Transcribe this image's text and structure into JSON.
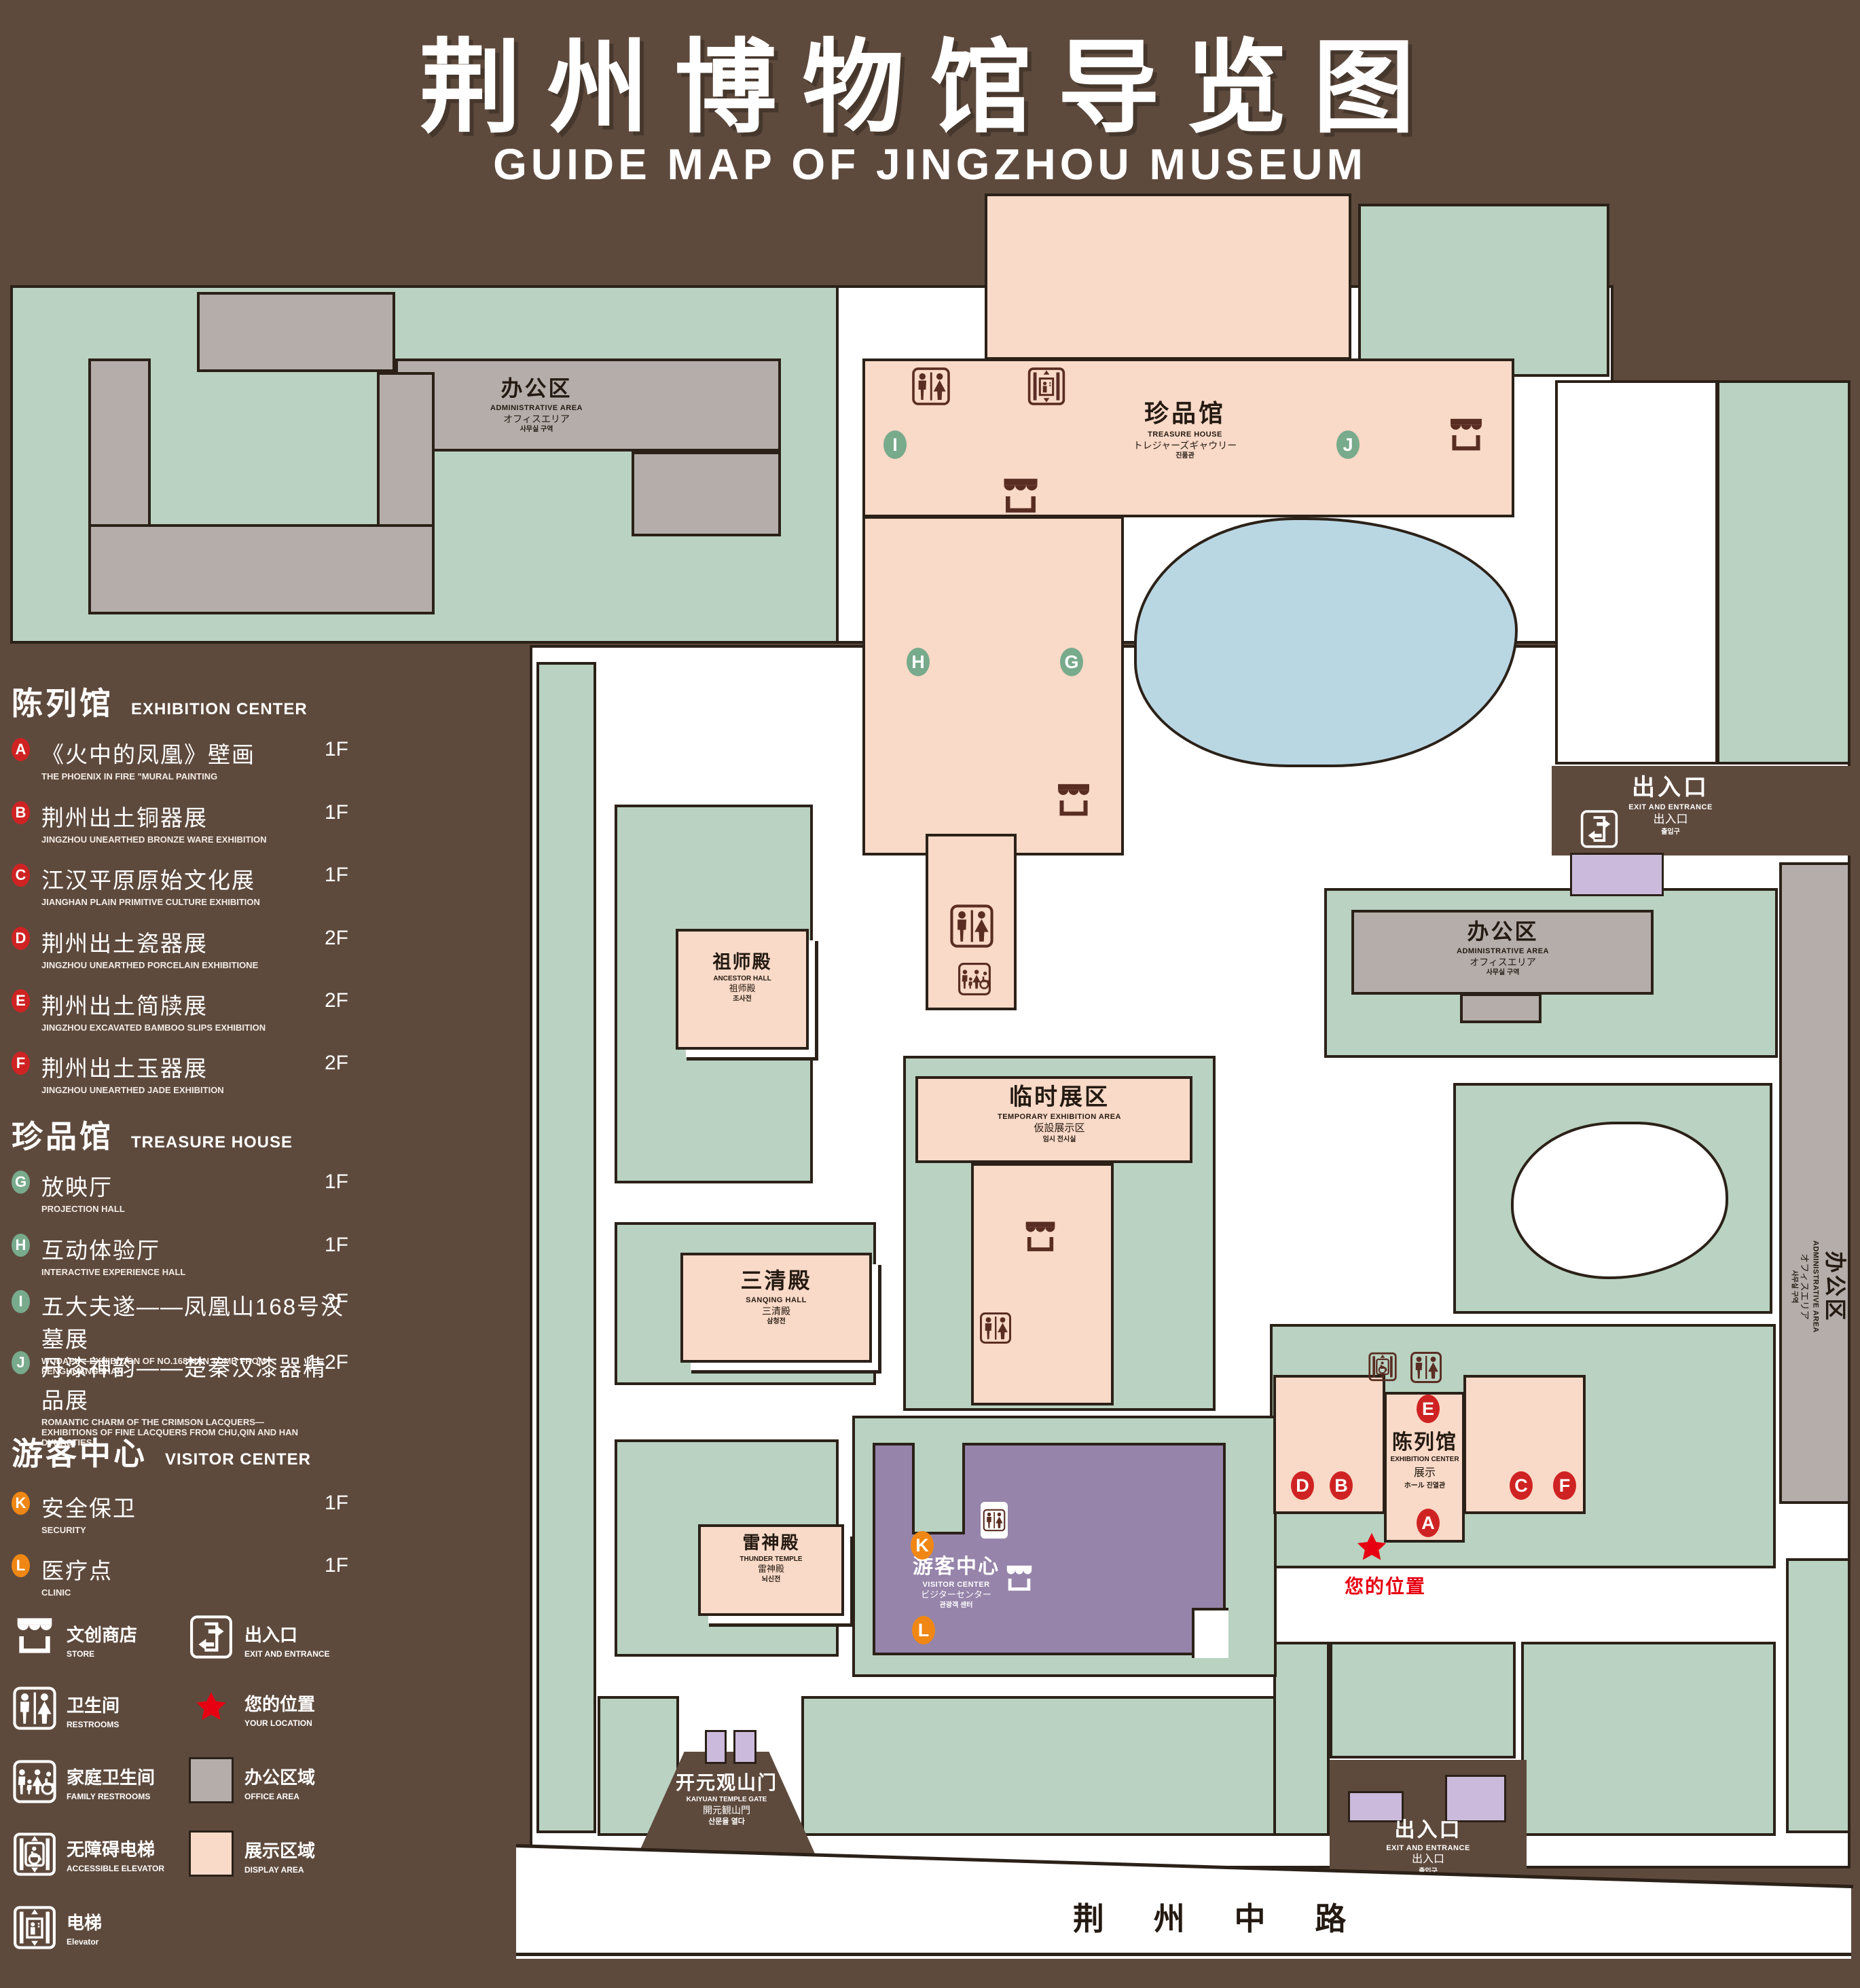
{
  "title": {
    "cn": "荆州博物馆导览图",
    "en": "GUIDE MAP OF JINGZHOU MUSEUM"
  },
  "legend": {
    "sections": [
      {
        "title_cn": "陈列馆",
        "title_en": "EXHIBITION CENTER",
        "items": [
          {
            "letter": "A",
            "cn": "《火中的凤凰》壁画",
            "en": "THE PHOENIX IN FIRE \"MURAL PAINTING",
            "floor": "1F"
          },
          {
            "letter": "B",
            "cn": "荆州出土铜器展",
            "en": "JINGZHOU UNEARTHED BRONZE WARE EXHIBITION",
            "floor": "1F"
          },
          {
            "letter": "C",
            "cn": "江汉平原原始文化展",
            "en": "JIANGHAN PLAIN PRIMITIVE CULTURE EXHIBITION",
            "floor": "1F"
          },
          {
            "letter": "D",
            "cn": "荆州出土瓷器展",
            "en": "JINGZHOU UNEARTHED PORCELAIN EXHIBITIONE",
            "floor": "2F"
          },
          {
            "letter": "E",
            "cn": "荆州出土简牍展",
            "en": "JINGZHOU EXCAVATED BAMBOO SLIPS EXHIBITION",
            "floor": "2F"
          },
          {
            "letter": "F",
            "cn": "荆州出土玉器展",
            "en": "JINGZHOU UNEARTHED JADE EXHIBITION",
            "floor": "2F"
          }
        ]
      },
      {
        "title_cn": "珍品馆",
        "title_en": "TREASURE HOUSE",
        "items": [
          {
            "letter": "G",
            "cn": "放映厅",
            "en": "PROJECTION HALL",
            "floor": "1F"
          },
          {
            "letter": "H",
            "cn": "互动体验厅",
            "en": "INTERACTIVE EXPERIENCE HALL",
            "floor": "1F"
          },
          {
            "letter": "I",
            "cn": "五大夫遂——凤凰山168号汉墓展",
            "en": "WUDAFU—EXHIBITION OF NO.168 HAN TOMB FROM FENGHUANGSHAN",
            "floor": "2F"
          },
          {
            "letter": "J",
            "cn": "丹漆神韵——楚秦汉漆器精品展",
            "en": "ROMANTIC CHARM OF THE CRIMSON LACQUERS—EXHIBITIONS OF FINE LACQUERS FROM CHU,QIN AND HAN DYNASTIES",
            "floor": "1-2F"
          }
        ]
      },
      {
        "title_cn": "游客中心",
        "title_en": "VISITOR CENTER",
        "items": [
          {
            "letter": "K",
            "cn": "安全保卫",
            "en": "SECURITY",
            "floor": "1F"
          },
          {
            "letter": "L",
            "cn": "医疗点",
            "en": "CLINIC",
            "floor": "1F"
          }
        ]
      }
    ],
    "symbols": [
      {
        "icon": "store-icon",
        "cn": "文创商店",
        "en": "STORE"
      },
      {
        "icon": "exit-icon",
        "cn": "出入口",
        "en": "EXIT AND ENTRANCE"
      },
      {
        "icon": "restroom-icon",
        "cn": "卫生间",
        "en": "RESTROOMS"
      },
      {
        "icon": "location-star-icon",
        "cn": "您的位置",
        "en": "YOUR LOCATION"
      },
      {
        "icon": "family-restroom-icon",
        "cn": "家庭卫生间",
        "en": "FAMILY RESTROOMS"
      },
      {
        "icon": "office-area-swatch",
        "cn": "办公区域",
        "en": "OFFICE AREA"
      },
      {
        "icon": "accessible-elevator-icon",
        "cn": "无障碍电梯",
        "en": "ACCESSIBLE ELEVATOR"
      },
      {
        "icon": "display-area-swatch",
        "cn": "展示区域",
        "en": "DISPLAY AREA"
      },
      {
        "icon": "elevator-icon",
        "cn": "电梯",
        "en": "Elevator"
      }
    ]
  },
  "map": {
    "buildings": {
      "admin_top_left": {
        "cn": "办公区",
        "en": "ADMINISTRATIVE AREA",
        "jp": "オフィスエリア",
        "kr": "사무실 구역"
      },
      "treasure_house": {
        "cn": "珍品馆",
        "en": "TREASURE HOUSE",
        "jp": "トレジャーズギャウリー",
        "kr": "진품관"
      },
      "ancestor_hall": {
        "cn": "祖师殿",
        "en": "ANCESTOR HALL",
        "jp": "祖师殿",
        "kr": "조사전"
      },
      "temporary_exhibition": {
        "cn": "临时展区",
        "en": "TEMPORARY EXHIBITION AREA",
        "jp": "仮設展示区",
        "kr": "임시 전시실"
      },
      "admin_right": {
        "cn": "办公区",
        "en": "ADMINISTRATIVE AREA",
        "jp": "オフィスエリア",
        "kr": "사무실 구역"
      },
      "admin_far_right": {
        "cn": "办公区",
        "en": "ADMINISTRATIVE AREA",
        "jp": "オフィスエリア",
        "kr": "사무실 구역"
      },
      "sanqing_hall": {
        "cn": "三清殿",
        "en": "SANQING HALL",
        "jp": "三清殿",
        "kr": "삼청전"
      },
      "thunder_temple": {
        "cn": "雷神殿",
        "en": "THUNDER TEMPLE",
        "jp": "雷神殿",
        "kr": "뇌신전"
      },
      "visitor_center": {
        "cn": "游客中心",
        "en": "VISITOR CENTER",
        "jp": "ビジターセンター",
        "kr": "관광객 센터"
      },
      "exhibition_center": {
        "cn": "陈列馆",
        "en": "EXHIBITION CENTER",
        "jp": "展示",
        "kr": "ホール 진열관"
      },
      "kaiyuan_gate": {
        "cn": "开元观山门",
        "en": "KAIYUAN TEMPLE GATE",
        "jp": "開元観山門",
        "kr": "산문을 열다"
      }
    },
    "exits": {
      "right": {
        "cn": "出入口",
        "en": "EXIT AND ENTRANCE",
        "jp": "出入口",
        "kr": "출입구"
      },
      "bottom": {
        "cn": "出入口",
        "en": "EXIT AND ENTRANCE",
        "jp": "出入口",
        "kr": "출입구"
      }
    },
    "road": {
      "name": "荆 州 中 路"
    },
    "your_location": {
      "cn": "您的位置"
    },
    "badges": {
      "a": "A",
      "b": "B",
      "c": "C",
      "d": "D",
      "e": "E",
      "f": "F",
      "g": "G",
      "h": "H",
      "i": "I",
      "j": "J",
      "k": "K",
      "l": "L"
    }
  },
  "colors": {
    "background_brown": "#5e4a3d",
    "outline": "#2b2118",
    "green_area": "#b9d2c1",
    "display_area_pink": "#f9d9c7",
    "office_area_gray": "#b4adaa",
    "visitor_center_purple": "#9684aa",
    "gate_lavender": "#cbbadb",
    "pond_blue": "#b9d6e3",
    "exhibition_badge_red": "#cf2323",
    "treasure_badge_green": "#78aa8c",
    "visitor_badge_orange": "#f08714",
    "location_red": "#e60012"
  }
}
